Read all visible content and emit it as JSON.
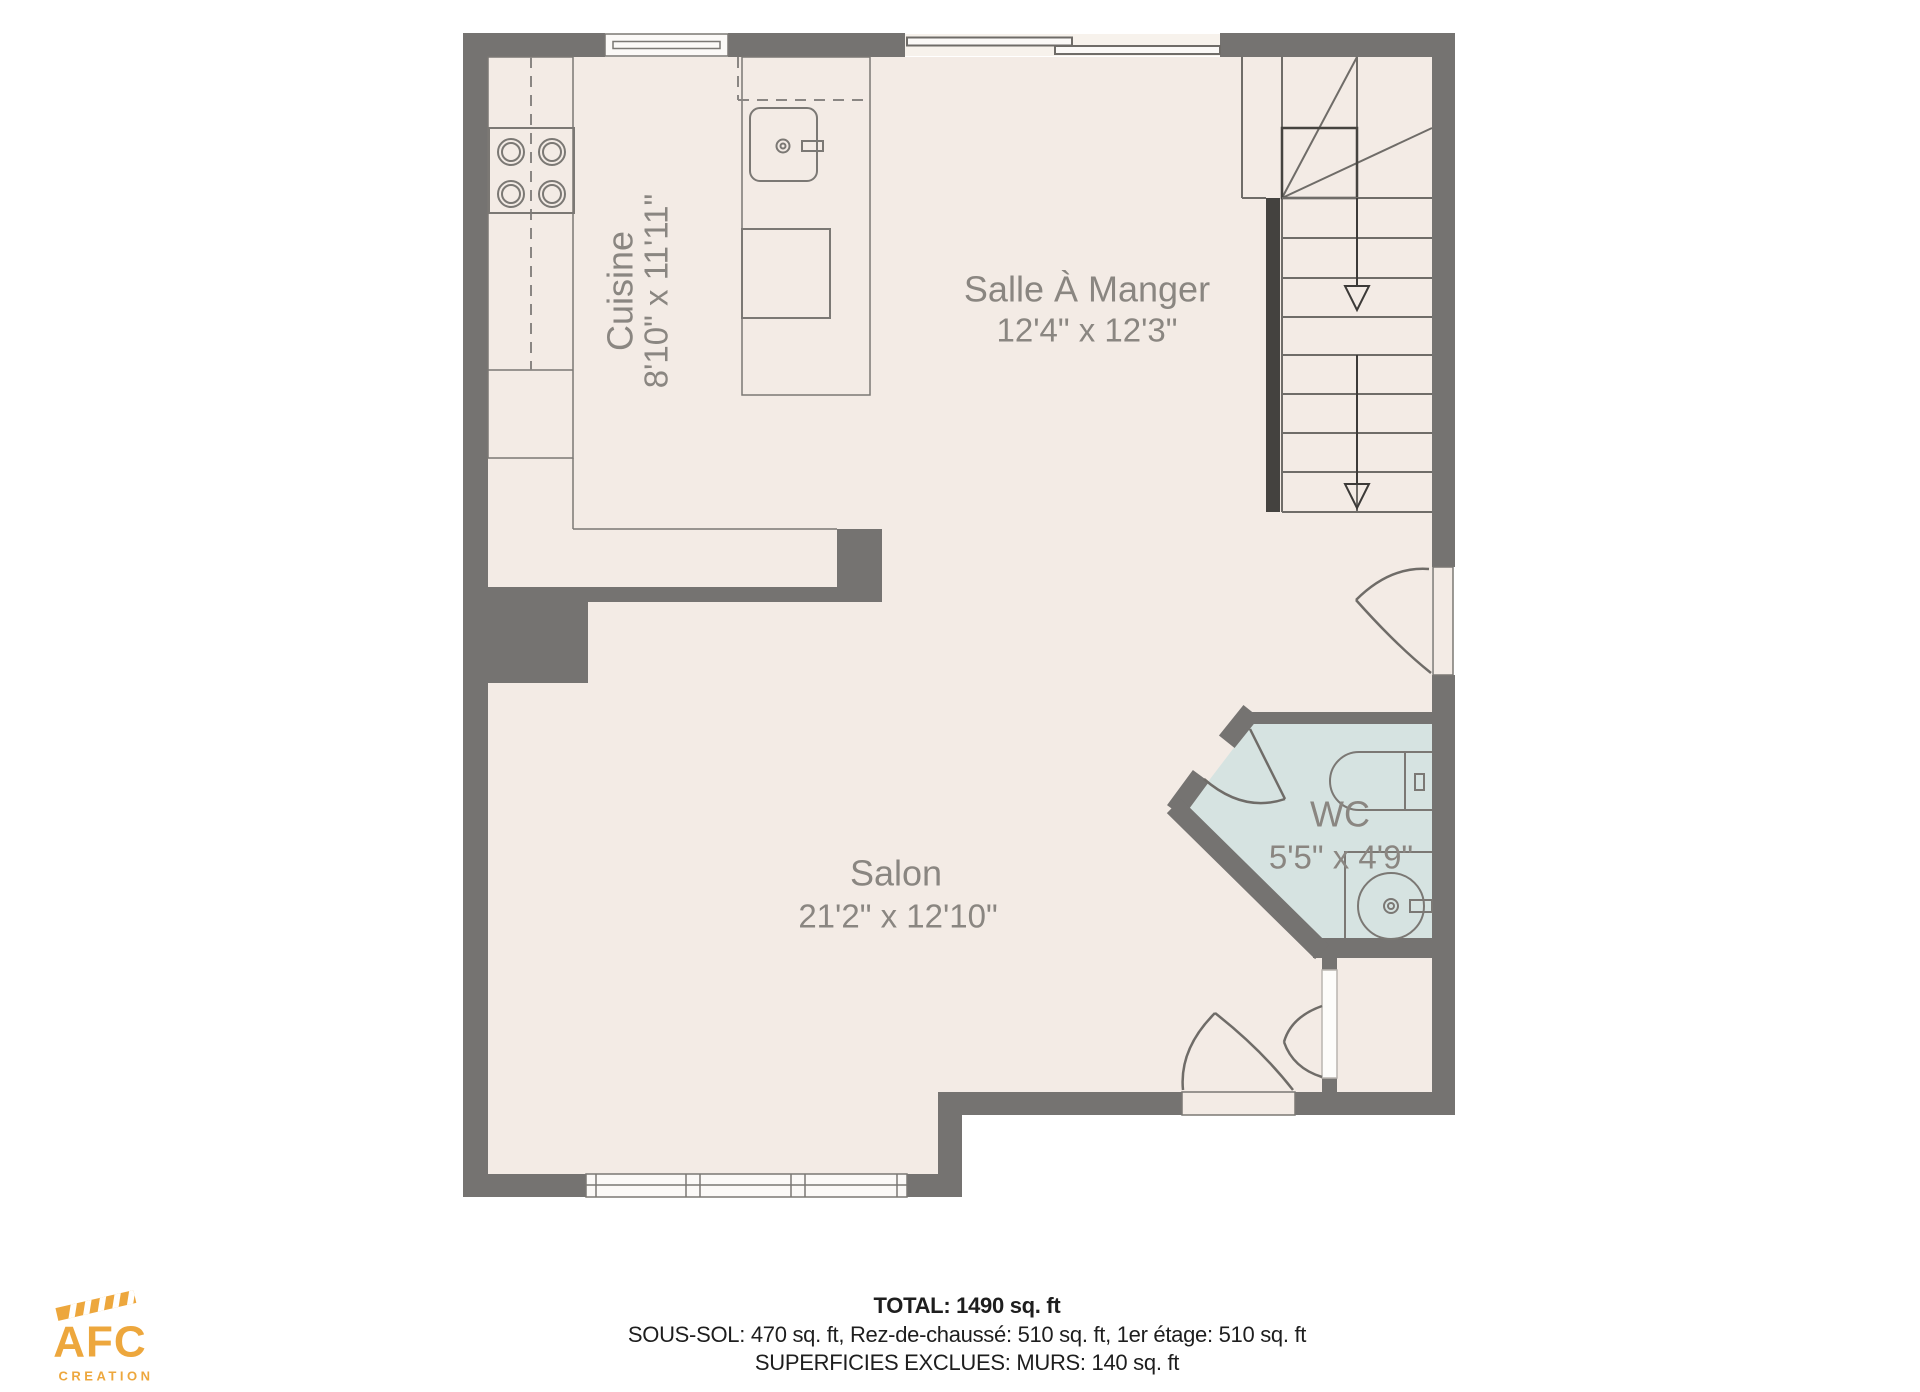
{
  "title": "Rez-de-chaussé floor plan",
  "colors": {
    "floor": "#f3ebe5",
    "wall": "#757371",
    "wc_floor": "#d6e3e1",
    "window_fill": "#fbf9f7",
    "line": "#7b7874",
    "label": "#8a8681",
    "summary_text": "#1e1e1e",
    "logo_accent": "#eda73d",
    "stair_rail": "#44423f"
  },
  "rooms": {
    "cuisine": {
      "name": "Cuisine",
      "dims": "8'10\" x 11'11\""
    },
    "salle_a_manger": {
      "name": "Salle À Manger",
      "dims": "12'4\" x 12'3\""
    },
    "salon": {
      "name": "Salon",
      "dims": "21'2\" x 12'10\""
    },
    "wc": {
      "name": "WC",
      "dims": "5'5\" x 4'9\""
    }
  },
  "fixtures": [
    "stove",
    "island-sink",
    "dishwasher",
    "toilet",
    "vanity-sink"
  ],
  "stairs": {
    "direction": "down",
    "arrow_count": 2
  },
  "summary": {
    "total": "TOTAL: 1490 sq. ft",
    "levels": "SOUS-SOL: 470 sq. ft, Rez-de-chaussé: 510 sq. ft, 1er étage: 510 sq. ft",
    "excluded": "SUPERFICIES EXCLUES: MURS: 140 sq. ft"
  },
  "logo": {
    "name": "AFC",
    "subtitle": "CREATION"
  }
}
